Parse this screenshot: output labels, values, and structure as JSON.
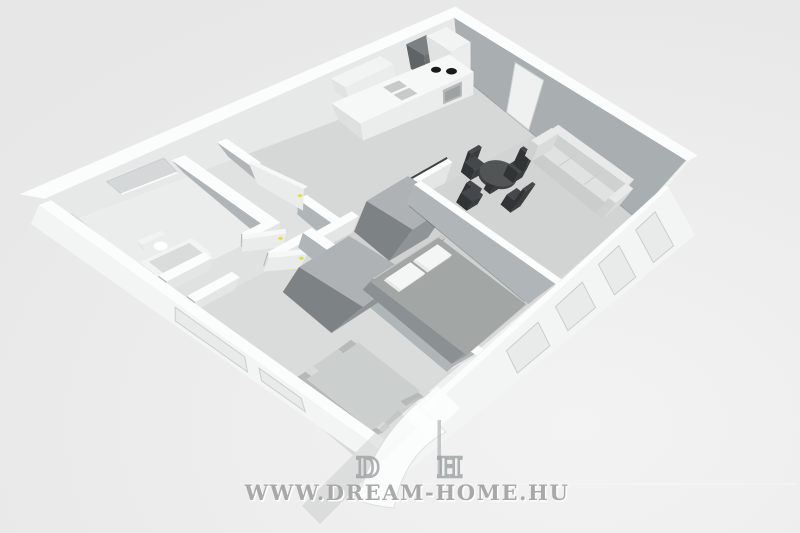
{
  "scene_type": "3d-floorplan-render",
  "watermark": {
    "url_text": "WWW.DREAM-HOME.HU",
    "logo_letter_1": "D",
    "logo_letter_2": "H"
  },
  "apartment": {
    "rooms": [
      {
        "name": "bathroom",
        "furniture": [
          "toilet",
          "bathtub",
          "window"
        ]
      },
      {
        "name": "hallway",
        "furniture": [
          "door-yellow-handle",
          "door-yellow-handle"
        ]
      },
      {
        "name": "kitchen",
        "furniture": [
          "counter",
          "double-sink",
          "cooktop",
          "oven",
          "tall-cabinet",
          "dark-appliance",
          "upper-cabinet"
        ]
      },
      {
        "name": "dining-area",
        "furniture": [
          "round-table",
          "chair",
          "chair",
          "chair",
          "chair"
        ]
      },
      {
        "name": "living-area",
        "furniture": [
          "sofa",
          "entry-door"
        ]
      },
      {
        "name": "bedroom",
        "furniture": [
          "double-bed",
          "pillows",
          "wardrobe",
          "door-yellow-handle"
        ]
      },
      {
        "name": "second-room",
        "furniture": [
          "single-bed",
          "wardrobe",
          "door-yellow-handle"
        ]
      }
    ]
  },
  "colors": {
    "bg": "#e7e7e7",
    "bgLight": "#f3f3f3",
    "floor": "#d8dad9",
    "bath": "#ebedec",
    "hall": "#e0e2e1",
    "kitchen": "#d6d8d7",
    "living": "#d2d4d3",
    "bedroom": "#cfd2d1",
    "small": "#dadcdb",
    "wallTop": "#fbfcfc",
    "wallInnerLight": "#e7e9e9",
    "wallInnerGray": "#a9aeb1",
    "wallFaceL": "#b0b5b7",
    "wallFaceF": "#e4e6e6",
    "wallOuter": "#f3f5f4",
    "windowGlass": "#e8ebea",
    "windowFrame": "#c9cecd",
    "windowRecess": "#d4d8d8",
    "doorRecess": "#eff1f1",
    "doorWhite": "#f6f8f7",
    "doorEdge": "#dfe2e1",
    "doorSide": "#e9eceb",
    "counterTop": "#f6f8f7",
    "counterL": "#dde0df",
    "counterF": "#eaedec",
    "cabinetTop": "#f2f4f3",
    "cabinetL": "#e0e3e2",
    "cabinetF": "#eaedec",
    "darkTop": "#7b8082",
    "darkL": "#5f6466",
    "darkF": "#6d7274",
    "wardTop": "#aeb2b4",
    "wardL": "#7d8284",
    "wardF": "#8f9496",
    "bedTop": "#a2a7a6",
    "bedL": "#8b9092",
    "bedF": "#969b9c",
    "pillow": "#f4f6f5",
    "pillowSide": "#e8eae9",
    "headboard": "#c7cbca",
    "sbedTop": "#cbcfce",
    "sbedL": "#b5b9b8",
    "sbedF": "#bfc3c2",
    "post": "#d8dbda",
    "sofaTop": "#dfe2e1",
    "sofaL": "#c9cdcc",
    "sofaF": "#d3d6d5",
    "sofaBackTop": "#e8eaea",
    "sofaBackL": "#cdd1d0",
    "sofaBackF": "#d8dbda",
    "tableTop": "#515556",
    "tableSide": "#3e4243",
    "chairTop": "#44484a",
    "chairL": "#303435",
    "chairF": "#3a3e3f",
    "sink": "#c6cac9",
    "burner": "#191b1b",
    "oven": "#b4b9b8",
    "ovenIn": "#9da2a2",
    "fixtureTop": "#f2f4f3",
    "fixtureL": "#e2e5e4",
    "fixtureF": "#eaedec",
    "tubInner": "#d9dcdb",
    "toiletWhite": "#fdfefe",
    "handle": "#e3e32f",
    "shadowLine": "#3f4445",
    "baseLine": "#8b9093",
    "wmGray": "#a2a2a2",
    "wmWhite": "#ffffff",
    "wmLetter": "#9aa0a1",
    "wmBand": "#aeb2b3",
    "wmSwoosh": "#fcfdfd",
    "wmSwooshEdge": "#d5d8d8",
    "wmStem": "#9ea3a4"
  }
}
